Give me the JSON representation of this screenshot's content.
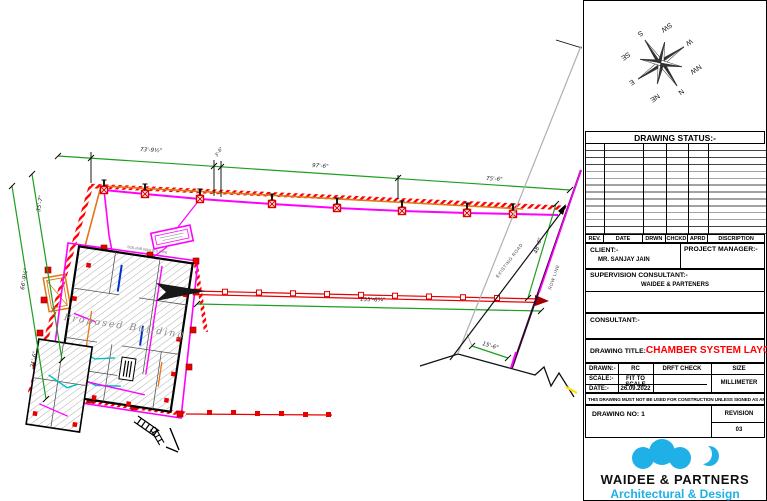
{
  "compass": [
    "N",
    "NE",
    "E",
    "SE",
    "S",
    "SW",
    "W",
    "NW"
  ],
  "plan": {
    "dimensions": {
      "top_left": "73'-9½\"",
      "top_small": "3'-6\"",
      "top_mid": "97'-6\"",
      "top_right": "75'-6\"",
      "left_upper": "35'-7\"",
      "left_middle": "66'-9½\"",
      "left_lower": "21'-6\"",
      "middle_run": "155'-6¾\"",
      "diagonal": "48'-6\"",
      "bottom_right": "15'-6\""
    },
    "labels": {
      "building": "Proposed Building",
      "pipe_note": "SOIL/AIR WASTED PIPE",
      "road": "EXISTING ROAD",
      "row": "ROW LINE"
    }
  },
  "title_block": {
    "drawing_status_label": "DRAWING STATUS:-",
    "rev_headers": [
      "REV.",
      "DATE",
      "DRWN",
      "CHCKD",
      "APRD",
      "DISCRIPTION"
    ],
    "client_label": "CLIENT:-",
    "client_name": "MR. SANJAY JAIN",
    "project_manager_label": "PROJECT MANAGER:-",
    "supervision_label": "SUPERVISION CONSULTANT:-",
    "supervision_name": "WAIDEE & PARTENERS",
    "consultant_label": "CONSULTANT:-",
    "drawing_title_label": "DRAWING TITLE:-",
    "drawing_title": "CHAMBER SYSTEM LAYOUT",
    "drawn_label": "DRAWN:-",
    "drawn_value": "RC",
    "drft_check_label": "DRFT CHECK",
    "size_label": "SIZE",
    "scale_label": "SCALE:-",
    "scale_value": "FIT TO SCALE",
    "size_value": "MILLIMETER",
    "date_label": "DATE:-",
    "date_value": "26.09.2022",
    "disclaimer": "THIS DRAWING MUST NOT BE USED FOR CONSTRUCTION UNLESS SIGNED AS APPROVED",
    "drawing_no": "DRAWING NO: 1",
    "revision_label": "REVISION",
    "revision_value": "03",
    "company_name": "WAIDEE & PARTNERS",
    "company_tagline": "Architectural & Design"
  },
  "colors": {
    "boundary_red": "#FF0000",
    "pipe_magenta": "#FF00FF",
    "pipe_orange": "#E07818",
    "dimension_green": "#1E9E1E",
    "brand_cyan": "#1FB0E8",
    "title_red": "#FF0000"
  }
}
